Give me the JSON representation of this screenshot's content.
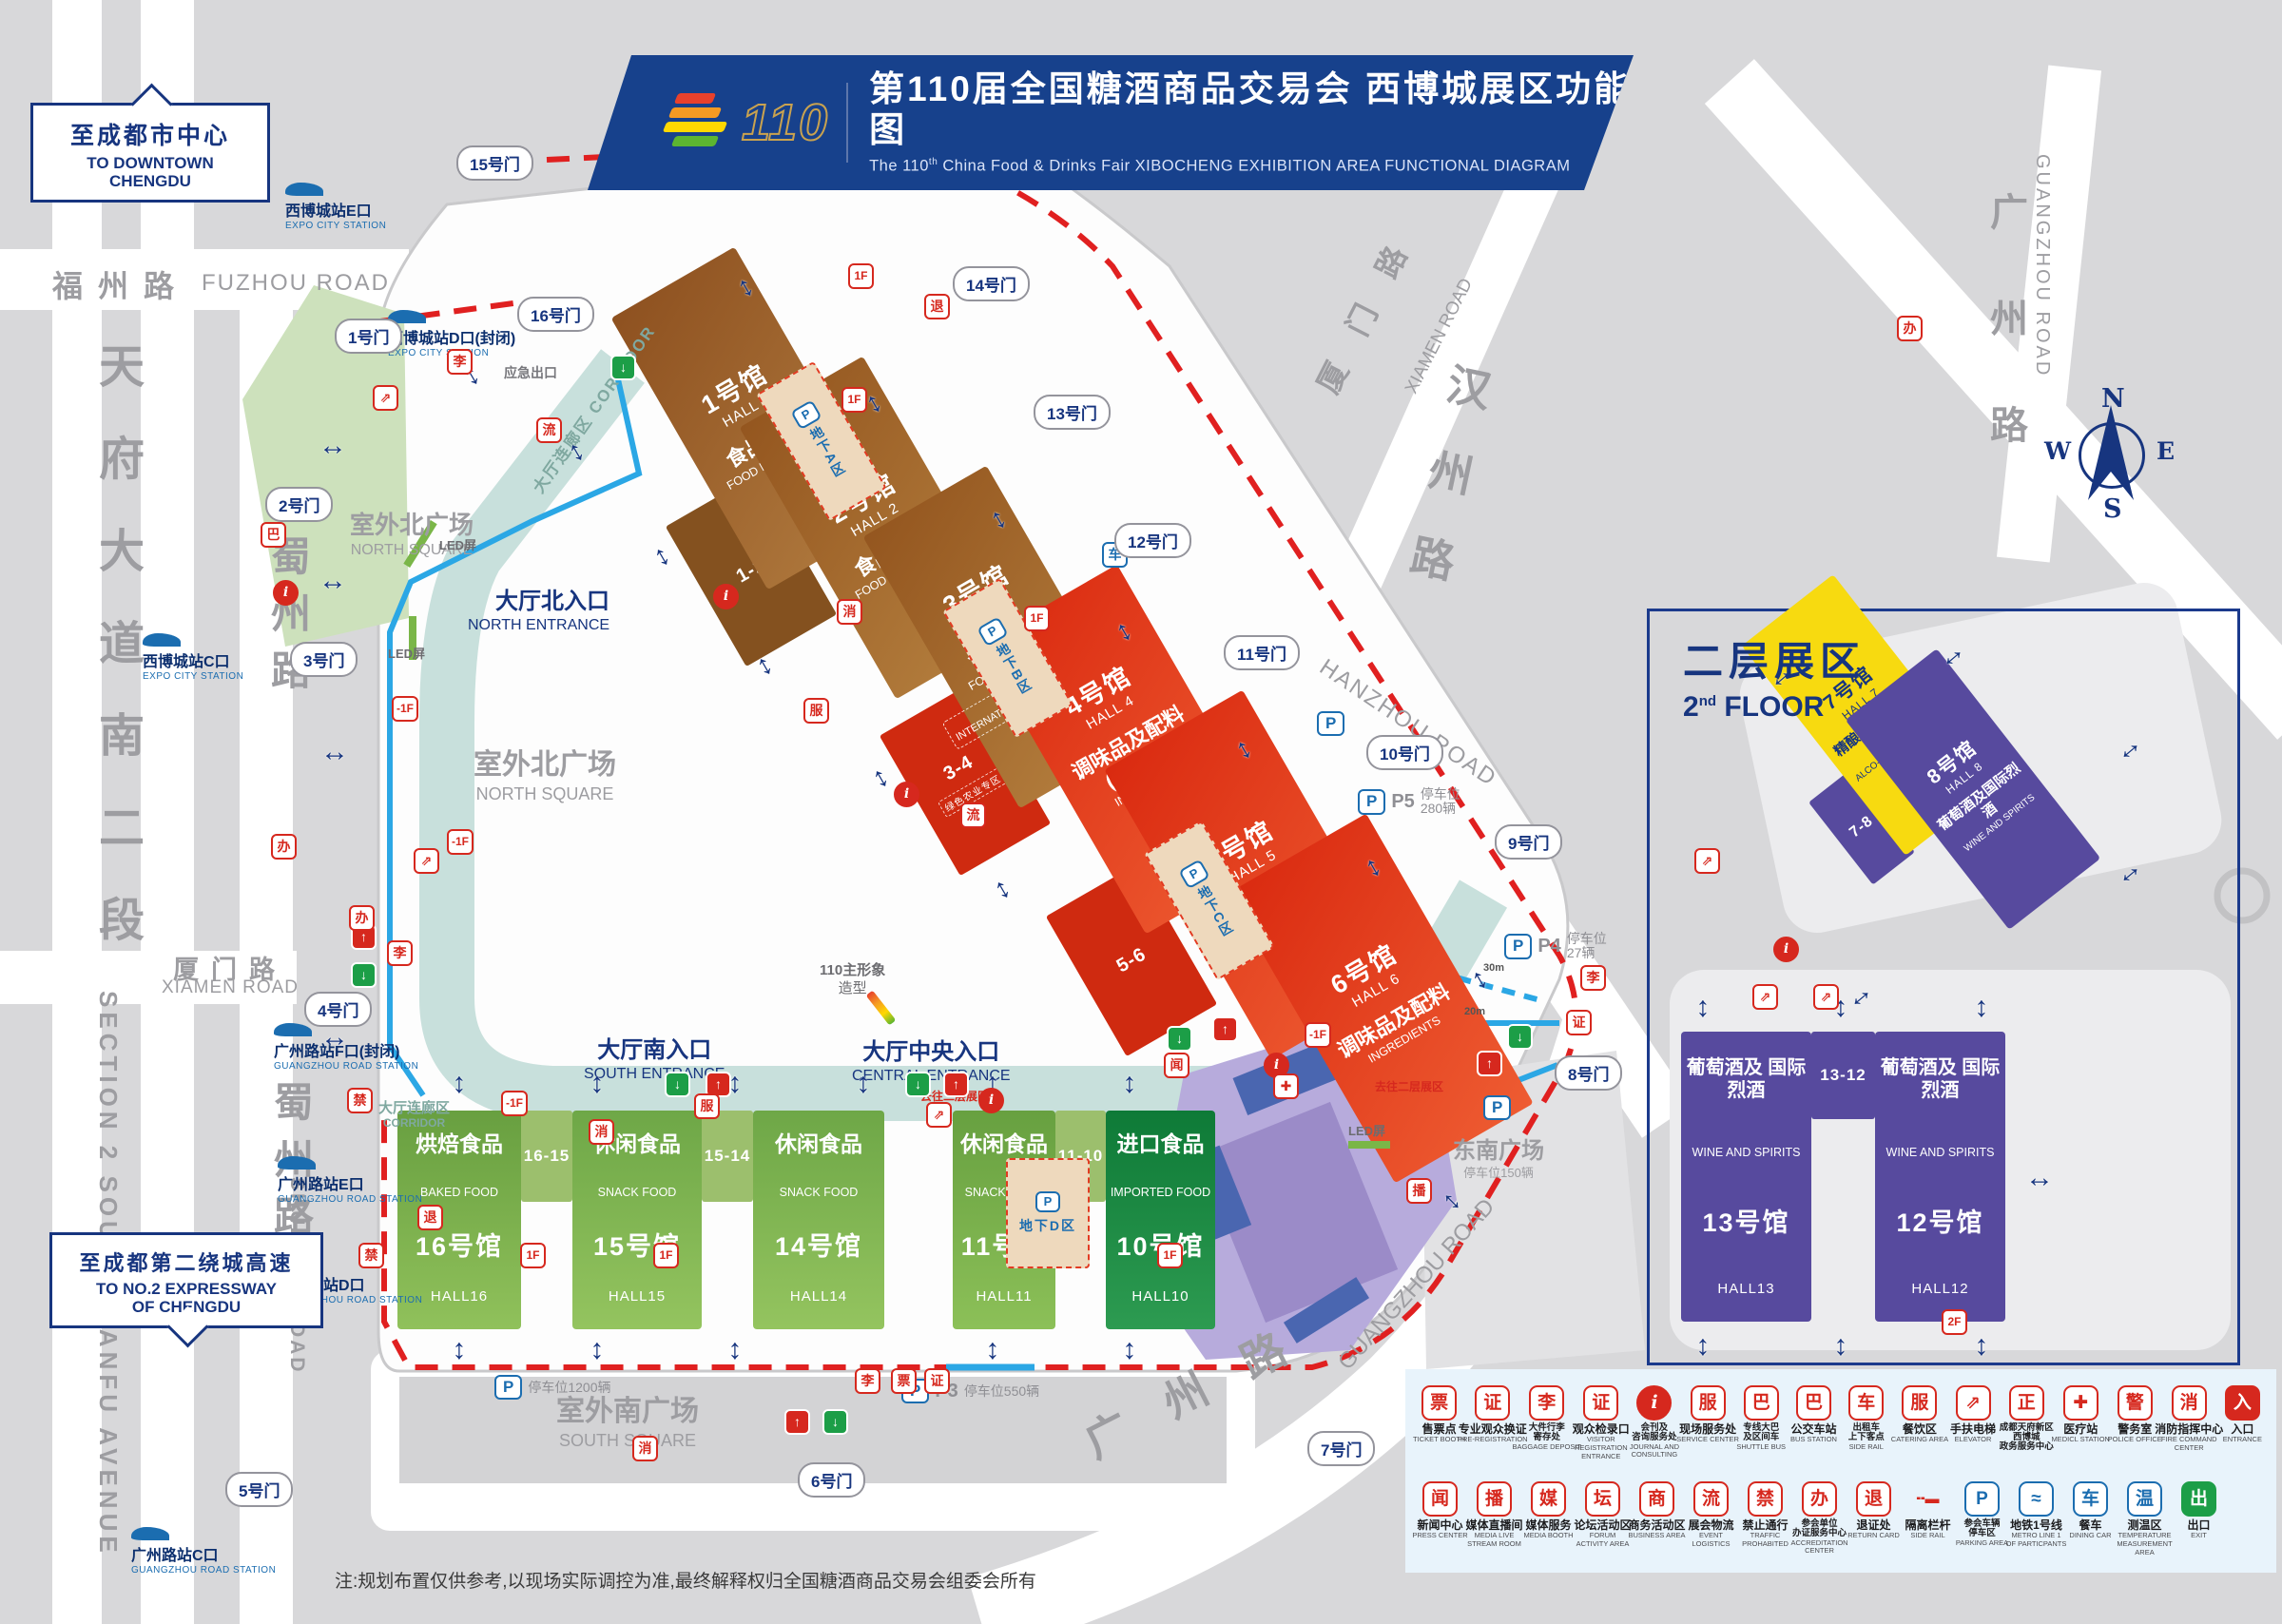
{
  "title": {
    "logo_number": "110",
    "cn": "第110届全国糖酒商品交易会 西博城展区功能图",
    "en_prefix": "The 110",
    "en_sup": "th",
    "en_main": " China Food & Drinks Fair ",
    "en_rest": "XIBOCHENG EXHIBITION AREA FUNCTIONAL DIAGRAM",
    "logo_colors": [
      "#e8412c",
      "#f59a23",
      "#ffd800",
      "#5cb531"
    ]
  },
  "signs": {
    "downtown_cn": "至成都市中心",
    "downtown_en1": "TO DOWNTOWN",
    "downtown_en2": "CHENGDU",
    "expressway_cn": "至成都第二绕城高速",
    "expressway_en1": "TO NO.2 EXPRESSWAY",
    "expressway_en2": "OF CHENGDU"
  },
  "floor2": {
    "title_cn": "二层展区",
    "title_num": "2",
    "title_sup": "nd",
    "title_rest": " FLOOR"
  },
  "compass": {
    "n": "N",
    "e": "E",
    "s": "S",
    "w": "W"
  },
  "note": "注:规划布置仅供参考,以现场实际调控为准,最终解释权归全国糖酒商品交易会组委会所有",
  "roads": [
    {
      "id": "rfz-cn",
      "text": "福州路"
    },
    {
      "id": "rfz-en",
      "text": "FUZHOU ROAD"
    },
    {
      "id": "rtf",
      "text": "天\n府\n大\n道\n南\n二\n段"
    },
    {
      "id": "rtf-en",
      "text": "SECTION 2 SOUTH TIANFU AVENUE"
    },
    {
      "id": "rsz1",
      "text": "蜀\n州\n路"
    },
    {
      "id": "rsz2",
      "text": "蜀\n州\n路"
    },
    {
      "id": "rsz2-en",
      "text": "SHUZHOU ROAD"
    },
    {
      "id": "rxm1-cn",
      "text": "厦门路"
    },
    {
      "id": "rxm1-en",
      "text": "XIAMEN ROAD"
    },
    {
      "id": "rxm2-cn",
      "text": "厦门路"
    },
    {
      "id": "rxm2-en",
      "text": "XIAMEN ROAD"
    },
    {
      "id": "rhz-cn",
      "text": "汉\n州\n路"
    },
    {
      "id": "rhz-en",
      "text": "HANZHOU ROAD"
    },
    {
      "id": "rgz1-cn",
      "text": "广\n州\n路"
    },
    {
      "id": "rgz1-en",
      "text": "GUANGZHOU ROAD"
    },
    {
      "id": "rgz2-cn",
      "text": "广州路"
    },
    {
      "id": "rgz2-en",
      "text": "GUANGZHOU ROAD"
    }
  ],
  "metro_stations": [
    {
      "id": "m_e_expo",
      "cn": "西博城站E口",
      "en": "EXPO CITY STATION"
    },
    {
      "id": "m_d_expo",
      "cn": "西博城站D口(封闭)",
      "en": "EXPO CITY STATION"
    },
    {
      "id": "m_c_expo",
      "cn": "西博城站C口",
      "en": "EXPO CITY STATION"
    },
    {
      "id": "m_f_gz",
      "cn": "广州路站F口(封闭)",
      "en": "GUANGZHOU ROAD STATION"
    },
    {
      "id": "m_e_gz",
      "cn": "广州路站E口",
      "en": "GUANGZHOU ROAD STATION"
    },
    {
      "id": "m_d_gz",
      "cn": "广州路站D口",
      "en": "GUANGZHOU ROAD STATION"
    },
    {
      "id": "m_c_gz",
      "cn": "广州路站C口",
      "en": "GUANGZHOU ROAD STATION"
    }
  ],
  "gates": [
    {
      "id": "g1",
      "label": "1号门"
    },
    {
      "id": "g2",
      "label": "2号门"
    },
    {
      "id": "g3",
      "label": "3号门"
    },
    {
      "id": "g4",
      "label": "4号门"
    },
    {
      "id": "g5",
      "label": "5号门"
    },
    {
      "id": "g6",
      "label": "6号门"
    },
    {
      "id": "g7",
      "label": "7号门"
    },
    {
      "id": "g8",
      "label": "8号门"
    },
    {
      "id": "g9",
      "label": "9号门"
    },
    {
      "id": "g10",
      "label": "10号门"
    },
    {
      "id": "g11",
      "label": "11号门"
    },
    {
      "id": "g12",
      "label": "12号门"
    },
    {
      "id": "g13",
      "label": "13号门"
    },
    {
      "id": "g14",
      "label": "14号门"
    },
    {
      "id": "g15",
      "label": "15号门"
    },
    {
      "id": "g16",
      "label": "16号门"
    }
  ],
  "halls": [
    {
      "id": "h1",
      "style": "rot",
      "num": "1号馆",
      "hall": "HALL 1",
      "cat": "食品机械",
      "cat_en": "FOOD MACHINERY"
    },
    {
      "id": "h2",
      "style": "rot",
      "num": "2号馆",
      "hall": "HALL 2",
      "cat": "食品机械",
      "cat_en": "FOOD MACHINERY"
    },
    {
      "id": "h3",
      "style": "rot",
      "num": "3号馆",
      "hall": "HALL 3",
      "cat": "食品机械",
      "cat_en": "FOOD MACHINERY",
      "sub": "国际机械专区",
      "sub_en": "INTERNATIONAL FOOD MACHINERY"
    },
    {
      "id": "h4",
      "style": "rot",
      "num": "4号馆",
      "hall": "HALL 4",
      "cat": "调味品及配料(川调馆)",
      "cat_en": "INGREDIENTS",
      "sub": "火锅专区",
      "sub_en": "HOT POT"
    },
    {
      "id": "h5",
      "style": "rot",
      "num": "5号馆",
      "hall": "HALL 5",
      "cat": "调味品及配料",
      "cat_en": "INGREDIENTS"
    },
    {
      "id": "h6",
      "style": "rot",
      "num": "6号馆",
      "hall": "HALL 6",
      "cat": "调味品及配料",
      "cat_en": "INGREDIENTS"
    },
    {
      "id": "h16",
      "style": "col",
      "num": "16号馆",
      "hall": "HALL16",
      "cat": "烘焙食品",
      "cat_en": "BAKED FOOD"
    },
    {
      "id": "h15",
      "style": "col",
      "num": "15号馆",
      "hall": "HALL15",
      "cat": "休闲食品",
      "cat_en": "SNACK FOOD"
    },
    {
      "id": "h14",
      "style": "col",
      "num": "14号馆",
      "hall": "HALL14",
      "cat": "休闲食品",
      "cat_en": "SNACK FOOD"
    },
    {
      "id": "h11",
      "style": "col",
      "num": "11号馆",
      "hall": "HALL11",
      "cat": "休闲食品",
      "cat_en": "SNACK FOOD"
    },
    {
      "id": "h10",
      "style": "col",
      "num": "10号馆",
      "hall": "HALL10",
      "cat": "进口食品",
      "cat_en": "IMPORTED FOOD"
    },
    {
      "id": "h7",
      "style": "rot78",
      "num": "7号馆",
      "hall": "HALL 7",
      "cat": "精酿啤酒及低度酒",
      "cat_en": "ALCO-POP AND BEER"
    },
    {
      "id": "h8",
      "style": "rot78",
      "num": "8号馆",
      "hall": "HALL 8",
      "cat": "葡萄酒及国际烈酒",
      "cat_en": "WINE AND SPIRITS"
    },
    {
      "id": "h13",
      "style": "col2f",
      "num": "13号馆",
      "hall": "HALL13",
      "cat": "葡萄酒及\n国际烈酒",
      "cat_en": "WINE AND\nSPIRITS"
    },
    {
      "id": "h12",
      "style": "col2f",
      "num": "12号馆",
      "hall": "HALL12",
      "cat": "葡萄酒及\n国际烈酒",
      "cat_en": "WINE AND\nSPIRITS"
    }
  ],
  "connectors": [
    {
      "id": "c12",
      "label": "1-2"
    },
    {
      "id": "c34",
      "label": "3-4",
      "sub": "绿色农业专区"
    },
    {
      "id": "c56",
      "label": "5-6"
    },
    {
      "id": "c1615",
      "label": "16-15"
    },
    {
      "id": "c1514",
      "label": "15-14"
    },
    {
      "id": "c1110",
      "label": "11-10"
    },
    {
      "id": "c78",
      "label": "7-8"
    },
    {
      "id": "c1312",
      "label": "13-12"
    }
  ],
  "underground": [
    {
      "id": "uA",
      "label": "地下A区"
    },
    {
      "id": "uB",
      "label": "地下B区"
    },
    {
      "id": "uC",
      "label": "地下C区"
    },
    {
      "id": "uD",
      "label": "地下D区"
    }
  ],
  "parking": [
    {
      "id": "pk3",
      "p": "P",
      "sub": "3",
      "text": "停车位550辆"
    },
    {
      "id": "pk4",
      "p": "P",
      "sub": "4",
      "text": "停车位\n27辆"
    },
    {
      "id": "pk5",
      "p": "P",
      "sub": "5",
      "text": "停车位\n280辆"
    },
    {
      "id": "pk12",
      "p": "P",
      "sub": "",
      "text": "停车位1200辆"
    },
    {
      "id": "pkse",
      "p": "P",
      "sub": "",
      "text": ""
    },
    {
      "id": "pkg10",
      "p": "P",
      "sub": "",
      "text": ""
    }
  ],
  "labels": [
    {
      "id": "lbl_nsq1",
      "cls": "gray",
      "lines": [
        "室外北广场",
        "NORTH SQUARE"
      ],
      "sizes": [
        26,
        16
      ]
    },
    {
      "id": "lbl_nsq2",
      "cls": "gray",
      "lines": [
        "室外北广场",
        "NORTH SQUARE"
      ],
      "sizes": [
        30,
        18
      ]
    },
    {
      "id": "lbl_ssq",
      "cls": "gray",
      "lines": [
        "室外南广场",
        "SOUTH SQUARE"
      ],
      "sizes": [
        30,
        18
      ]
    },
    {
      "id": "lbl_sesq",
      "cls": "gray",
      "lines": [
        "东南广场",
        "停车位150辆"
      ],
      "sizes": [
        24,
        13
      ]
    },
    {
      "id": "lbl_cor1",
      "cls": "",
      "lines": [
        "大厅连廊区 CORRIDOR"
      ],
      "sizes": [
        17
      ]
    },
    {
      "id": "lbl_cor2",
      "cls": "",
      "lines": [
        "大厅连廊区",
        "CORRIDOR"
      ],
      "sizes": [
        15,
        12
      ]
    },
    {
      "id": "lbl_nent",
      "cls": "",
      "lines": [
        "大厅北入口",
        "NORTH ENTRANCE"
      ],
      "sizes": [
        24,
        16
      ]
    },
    {
      "id": "lbl_sent",
      "cls": "",
      "lines": [
        "大厅南入口",
        "SOUTH ENTRANCE"
      ],
      "sizes": [
        24,
        16
      ]
    },
    {
      "id": "lbl_cent",
      "cls": "",
      "lines": [
        "大厅中央入口",
        "CENTRAL ENTRANCE"
      ],
      "sizes": [
        24,
        16
      ]
    },
    {
      "id": "lbl_110",
      "cls": "",
      "lines": [
        "110主形象",
        "造型"
      ],
      "sizes": [
        15,
        15
      ]
    },
    {
      "id": "lbl_emg",
      "cls": "",
      "lines": [
        "应急出口"
      ],
      "sizes": [
        14
      ]
    },
    {
      "id": "lbl_led1",
      "cls": "",
      "lines": [
        "LED屏"
      ],
      "sizes": [
        13
      ]
    },
    {
      "id": "lbl_led2",
      "cls": "",
      "lines": [
        "LED屏"
      ],
      "sizes": [
        13
      ]
    },
    {
      "id": "lbl_led3",
      "cls": "",
      "lines": [
        "LED屏"
      ],
      "sizes": [
        13
      ]
    },
    {
      "id": "lbl_go1",
      "cls": "",
      "lines": [
        "去往二层展区"
      ],
      "sizes": [
        12
      ]
    },
    {
      "id": "lbl_go2",
      "cls": "",
      "lines": [
        "去往二层展区"
      ],
      "sizes": [
        12
      ]
    },
    {
      "id": "lbl_30m",
      "cls": "",
      "lines": [
        "30m"
      ],
      "sizes": [
        11
      ]
    },
    {
      "id": "lbl_20m",
      "cls": "",
      "lines": [
        "20m"
      ],
      "sizes": [
        11
      ]
    }
  ],
  "icons": {
    "arrow": "↔",
    "info-icon": "i",
    "entrance-icon": "↑",
    "exit-icon": "↓",
    "escalator-icon": "⇗",
    "service-icon": "服",
    "fire-icon": "消",
    "medical-icon": "✚",
    "baggage-icon": "李",
    "ticket-icon": "票",
    "registration-icon": "证",
    "return-card-icon": "退",
    "logistics-icon": "流",
    "dining-car-icon": "车",
    "no-entry-icon": "禁",
    "accreditation-icon": "办",
    "press-icon": "闻",
    "media-icon": "播",
    "bus-icon": "巴",
    "floor-1f": "1F",
    "floor-minus1f": "-1F",
    "floor-2f": "2F"
  },
  "legend": {
    "rows": [
      [
        {
          "cn": "售票点",
          "en": "TICKET BOOTH",
          "icon": "ticket-icon",
          "color": "red"
        },
        {
          "cn": "专业观众换证",
          "en": "PRE-REGISTRATION",
          "icon": "registration-icon",
          "color": "red"
        },
        {
          "cn": "大件行李\n寄存处",
          "en": "BAGGAGE DEPOSIT",
          "icon": "baggage-icon",
          "color": "red"
        },
        {
          "cn": "观众检录口",
          "en": "VISITOR\nREGISTRATION\nENTRANCE",
          "icon": "registration-icon",
          "color": "red"
        },
        {
          "cn": "会刊及\n咨询服务处",
          "en": "JOURNAL AND\nCONSULTING",
          "icon": "info-icon",
          "color": "circle"
        },
        {
          "cn": "现场服务处",
          "en": "SERVICE CENTER",
          "icon": "service-icon",
          "color": "red"
        },
        {
          "cn": "专线大巴\n及区间车",
          "en": "SHUTTLE BUS",
          "icon": "bus-icon",
          "color": "red"
        },
        {
          "cn": "公交车站",
          "en": "BUS STATION",
          "icon": "bus-icon",
          "color": "red"
        },
        {
          "cn": "出租车\n上下客点",
          "en": "SIDE RAIL",
          "icon": "dining-car-icon",
          "color": "red"
        },
        {
          "cn": "餐饮区",
          "en": "CATERING AREA",
          "icon": "service-icon",
          "color": "red"
        },
        {
          "cn": "手扶电梯",
          "en": "ELEVATOR",
          "icon": "escalator-icon",
          "color": "red"
        },
        {
          "cn": "成都天府新区\n西博城\n政务服务中心",
          "en": "",
          "icon": "registration-icon",
          "color": "red",
          "glyph": "正"
        },
        {
          "cn": "医疗站",
          "en": "MEDICL STATION",
          "icon": "medical-icon",
          "color": "red"
        },
        {
          "cn": "警务室",
          "en": "POLICE OFFICE",
          "icon": "service-icon",
          "color": "red",
          "glyph": "警"
        },
        {
          "cn": "消防指挥中心",
          "en": "FIRE COMMAND\nCENTER",
          "icon": "fire-icon",
          "color": "red"
        },
        {
          "cn": "入口",
          "en": "ENTRANCE",
          "icon": "entrance-icon",
          "color": "redfill",
          "glyph": "入"
        }
      ],
      [
        {
          "cn": "新闻中心",
          "en": "PRESS CENTER",
          "icon": "press-icon",
          "color": "red"
        },
        {
          "cn": "媒体直播间",
          "en": "MEDIA LIVE\nSTREAM ROOM",
          "icon": "media-icon",
          "color": "red"
        },
        {
          "cn": "媒体服务",
          "en": "MEDIA BOOTH",
          "icon": "media-icon",
          "color": "red",
          "glyph": "媒"
        },
        {
          "cn": "论坛活动区",
          "en": "FORUM\nACTIVITY AREA",
          "icon": "service-icon",
          "color": "red",
          "glyph": "坛"
        },
        {
          "cn": "商务活动区",
          "en": "BUSINESS AREA",
          "icon": "service-icon",
          "color": "red",
          "glyph": "商"
        },
        {
          "cn": "展会物流",
          "en": "EVENT\nLOGISTICS",
          "icon": "logistics-icon",
          "color": "red"
        },
        {
          "cn": "禁止通行",
          "en": "TRAFFIC\nPROHABITED",
          "icon": "no-entry-icon",
          "color": "red"
        },
        {
          "cn": "参会单位\n办证服务中心",
          "en": "ACCREDITATION\nCENTER",
          "icon": "accreditation-icon",
          "color": "red"
        },
        {
          "cn": "退证处",
          "en": "RETURN CARD",
          "icon": "return-card-icon",
          "color": "red"
        },
        {
          "cn": "隔离栏杆",
          "en": "SIDE RAIL",
          "icon": "barrier-icon",
          "color": "nob",
          "glyph": "╍▬"
        },
        {
          "cn": "参会车辆\n停车区",
          "en": "PARKING AREA",
          "icon": "parking-icon",
          "color": "blue",
          "glyph": "P"
        },
        {
          "cn": "地铁1号线",
          "en": "METRO LINE 1\nOF PARTICPANTS",
          "icon": "metro-icon",
          "color": "blue",
          "glyph": "≈"
        },
        {
          "cn": "餐车",
          "en": "DINING CAR",
          "icon": "dining-car-icon",
          "color": "blue"
        },
        {
          "cn": "测温区",
          "en": "TEMPERATURE\nMEASUREMENT\nAREA",
          "icon": "thermometer-icon",
          "color": "blue",
          "glyph": "温"
        },
        {
          "cn": "出口",
          "en": "EXIT",
          "icon": "exit-icon",
          "color": "green",
          "glyph": "出"
        }
      ]
    ]
  }
}
